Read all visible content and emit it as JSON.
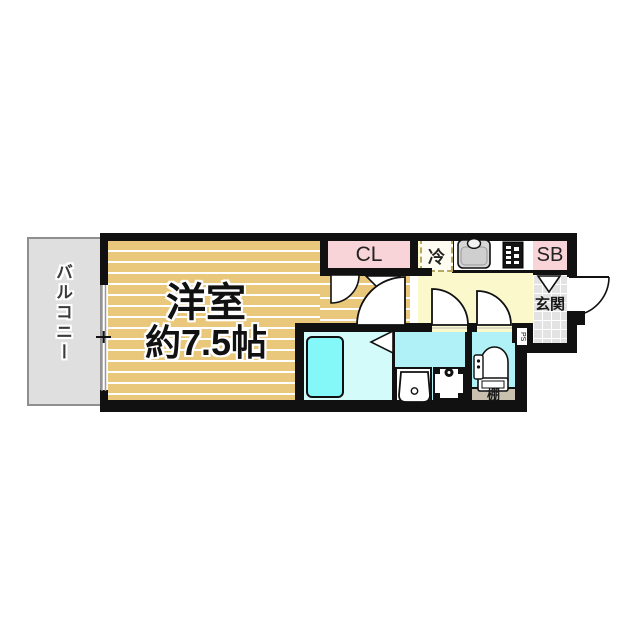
{
  "rooms": {
    "balcony": {
      "label": "バルコニー"
    },
    "main_room": {
      "name": "洋室",
      "size": "約7.5帖"
    },
    "closet": {
      "label": "CL"
    },
    "refrigerator_space": {
      "label": "冷"
    },
    "shoe_box": {
      "label": "SB"
    },
    "entrance": {
      "label": "玄関"
    },
    "pipe_space": {
      "label": "PS"
    },
    "shelf": {
      "label": "棚"
    }
  },
  "colors": {
    "room_floor_tan": "#eac87b",
    "closet_pink": "#f8d3d7",
    "kitchen_yellow": "#fbf8cc",
    "wet_area_cyan": "#aff1f7",
    "bathroom_floor_cyan": "#d2fbfa",
    "bathtub_cyan": "#84f8f8",
    "balcony_gray": "#dfdfdf",
    "entrance_tile_gray": "#e3e3e3",
    "shelf_gray": "#c9c0b0",
    "wall_black": "#111111"
  }
}
